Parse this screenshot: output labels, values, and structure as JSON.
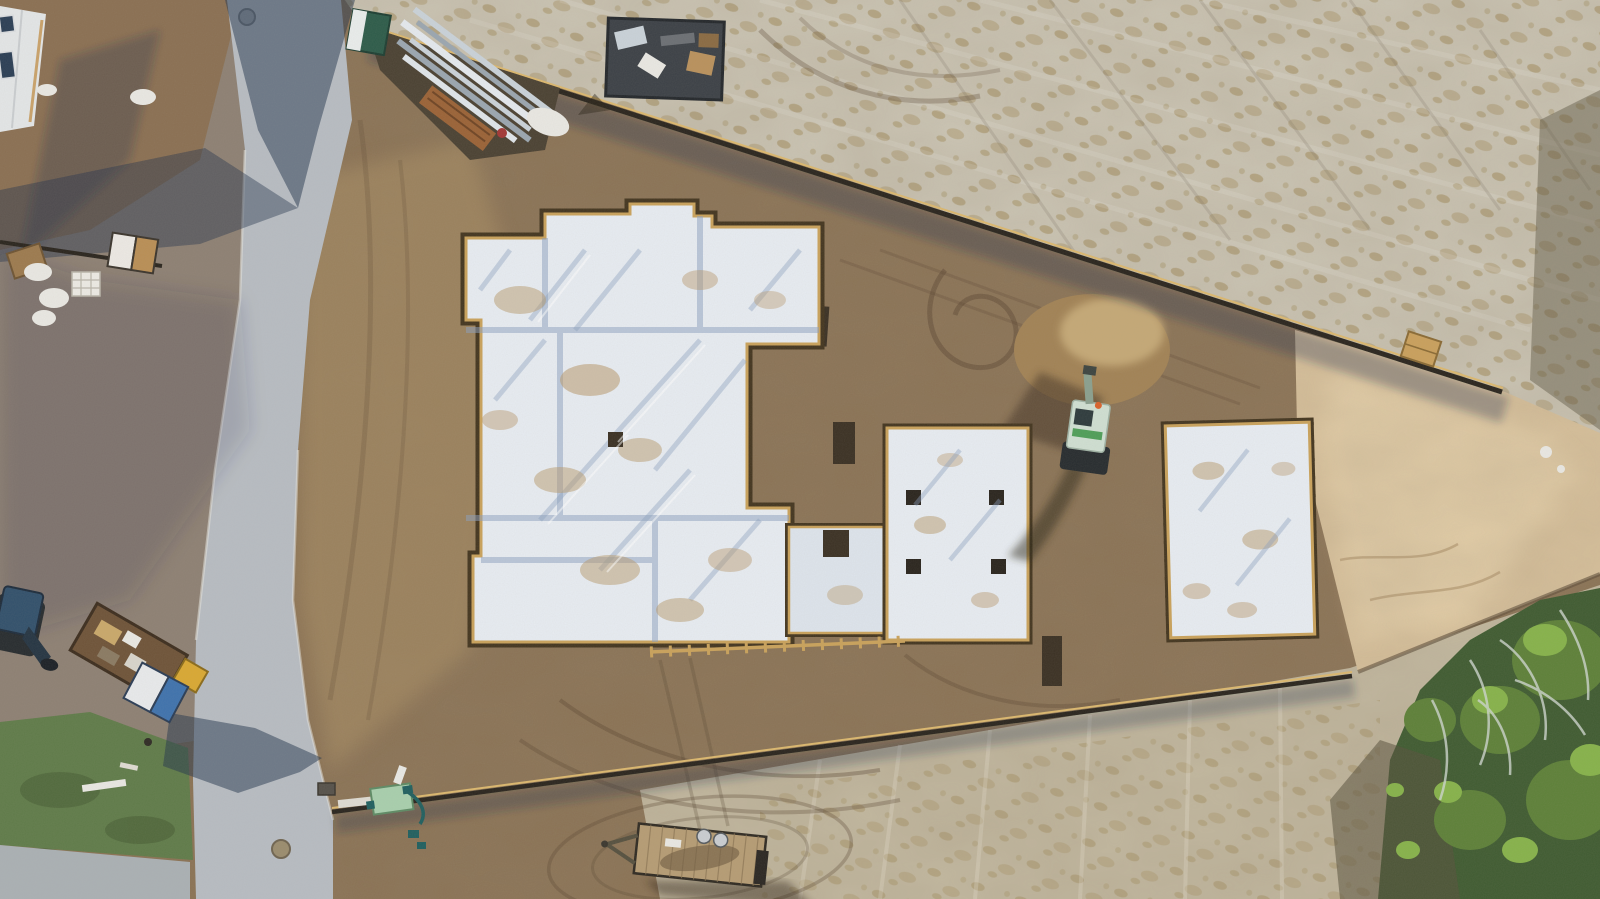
{
  "scene": {
    "description": "Aerial top-down drone photograph of a residential construction site. An irregular house slab foundation covered in white vapor-barrier plastic with wooden form boards sits in brown graded dirt, flanked by two smaller rectangular foundation pads. A concrete road with long building shadows runs along the left, a sandy tilled field fills the upper right, a tan sand pad and green trees occupy the lower right. Equipment on site includes a mini excavator, a yellow loader, a debris dumpster, a flatbed trailer, a porta-potty and stacks of steel framing.",
    "setting": "daytime, low sun from upper right casting long blue shadows toward lower left"
  },
  "colors": {
    "dirt_base": "#8a7254",
    "dirt_gray": "#8d8073",
    "dirt_brown_corner": "#8a6f52",
    "dirt_light_wash": "#ab9065",
    "sand_field": "#cbc5b4",
    "sand_tuft": "#ac9b72",
    "sand_pad": "#d9c29c",
    "bottom_sand": "#c2b89f",
    "road": "#b7bcc2",
    "concrete_apron": "#aab0b4",
    "grass": "#5f7b49",
    "shadow": "#22334c",
    "slab_plastic": "#e7ecf2",
    "slab_shadow_tint": "#8ba0bf",
    "slab_stain": "#b8996c",
    "porch_slab": "#dde4ec",
    "formboard": "#c9a25b",
    "trench": "#43351f",
    "fence_dark": "#29241d",
    "fence_lit": "#dcb86e",
    "pit_dark": "#3a3023",
    "mound": "#a18255",
    "mound_light": "#c4a876",
    "trees_dark": "#3f5b31",
    "trees_mid": "#5d8038",
    "trees_light": "#86b24a",
    "branches": "#cdd5cd",
    "scrub_dark": "#57503c",
    "dumpster": "#3b4046",
    "metal": "#c9d2d9",
    "metal_dark": "#9aa6b0",
    "rust": "#9a6236",
    "laydown_soil": "#4a4132",
    "portapotty_green": "#2c5b49",
    "portapotty_white": "#e9edec",
    "house_roof": "#e3e6e7",
    "house_window": "#2a3e55",
    "loader_yellow": "#d9a832",
    "trailer_rust": "#6e5338",
    "tarp_blue": "#3e72ad",
    "tarp_white": "#e8eaec",
    "dark_excavator": "#31506b",
    "excavator_body": "#cfdfd2",
    "excavator_track": "#262b2e",
    "excavator_stripe": "#4e9e58",
    "flatbed_wood": "#b59c74",
    "drum_gray": "#c9cdd1",
    "pump_green": "#a8cfad",
    "hose_teal": "#1f5f5f",
    "crate_wood": "#c9a05c",
    "white_debris": "#e9e8e3"
  },
  "objects": [
    {
      "name": "main-house-foundation",
      "description": "irregular slab with white vapor barrier and form boards"
    },
    {
      "name": "porch-pad",
      "description": "attached pad at lower right of main slab with square blockout"
    },
    {
      "name": "middle-pad",
      "description": "rectangular pad with four dark square blockouts"
    },
    {
      "name": "right-pad",
      "description": "rectangular pad, white plastic with dirt stains"
    },
    {
      "name": "mini-excavator",
      "description": "light green machine between pads casting long shadow"
    },
    {
      "name": "debris-dumpster",
      "description": "dark open-top container full of scrap at top center"
    },
    {
      "name": "steel-framing-pile",
      "description": "diagonal stack of silver metal studs near road"
    },
    {
      "name": "porta-potty",
      "description": "green portable toilet at road edge"
    },
    {
      "name": "house-under-construction",
      "description": "white building cut by top-left corner"
    },
    {
      "name": "yellow-loader-trailer",
      "description": "rusty dump trailer with yellow cab, lower left"
    },
    {
      "name": "dark-excavator",
      "description": "blue-black machine at left edge"
    },
    {
      "name": "tarp-container",
      "description": "white and blue wrapped container on lawn"
    },
    {
      "name": "flatbed-trailer",
      "description": "wooden-deck trailer at bottom center"
    },
    {
      "name": "pump-box",
      "description": "light green pump with teal hoses on lower silt fence"
    },
    {
      "name": "silt-fence-upper",
      "description": "diagonal sediment fence from top left to right"
    },
    {
      "name": "silt-fence-lower",
      "description": "diagonal sediment fence across bottom"
    },
    {
      "name": "road",
      "description": "concrete street with manholes crossing left side"
    },
    {
      "name": "sand-pad",
      "description": "tan compacted sand pad at right"
    },
    {
      "name": "trees",
      "description": "green scrub trees with bare branches, bottom right"
    }
  ]
}
